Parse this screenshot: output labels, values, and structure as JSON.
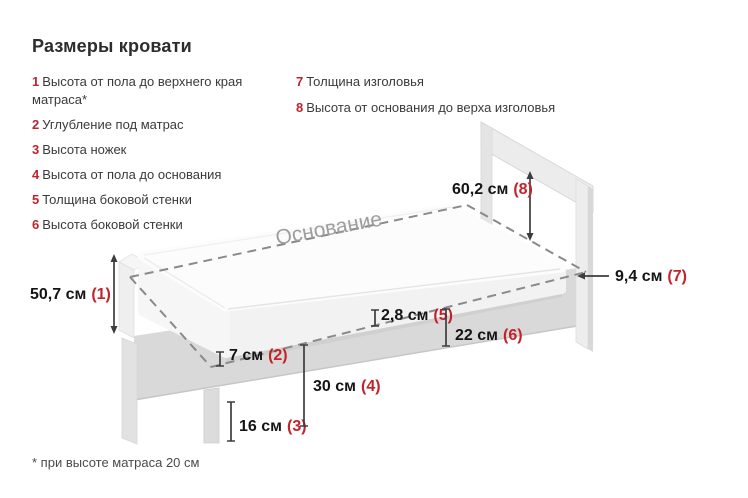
{
  "title": "Размеры кровати",
  "legend": {
    "col1": [
      {
        "n": "1",
        "text": "Высота от пола до верхнего края матраса*"
      },
      {
        "n": "2",
        "text": "Углубление под матрас"
      },
      {
        "n": "3",
        "text": "Высота ножек"
      },
      {
        "n": "4",
        "text": "Высота от пола до основания"
      },
      {
        "n": "5",
        "text": "Толщина боковой стенки"
      },
      {
        "n": "6",
        "text": "Высота боковой стенки"
      }
    ],
    "col2": [
      {
        "n": "7",
        "text": "Толщина изголовья"
      },
      {
        "n": "8",
        "text": "Высота от основания до верха изголовья"
      }
    ]
  },
  "diagram": {
    "base_label": "Основание",
    "dims": {
      "d1": {
        "value": "50,7 см",
        "ref": "(1)"
      },
      "d2": {
        "value": "7 см",
        "ref": "(2)"
      },
      "d3": {
        "value": "16 см",
        "ref": "(3)"
      },
      "d4": {
        "value": "30 см",
        "ref": "(4)"
      },
      "d5": {
        "value": "2,8 см",
        "ref": "(5)"
      },
      "d6": {
        "value": "22 см",
        "ref": "(6)"
      },
      "d7": {
        "value": "9,4 см",
        "ref": "(7)"
      },
      "d8": {
        "value": "60,2 см",
        "ref": "(8)"
      }
    }
  },
  "footnote": "* при высоте матраса 20 см",
  "colors": {
    "accent_red": "#c2232b",
    "heading_text": "#2d2d2d",
    "body_text": "#3a3a3a",
    "dash_gray": "#8a8a8a",
    "frame_gray": "#d9d9d9",
    "mattress_white": "#fcfcfc"
  }
}
